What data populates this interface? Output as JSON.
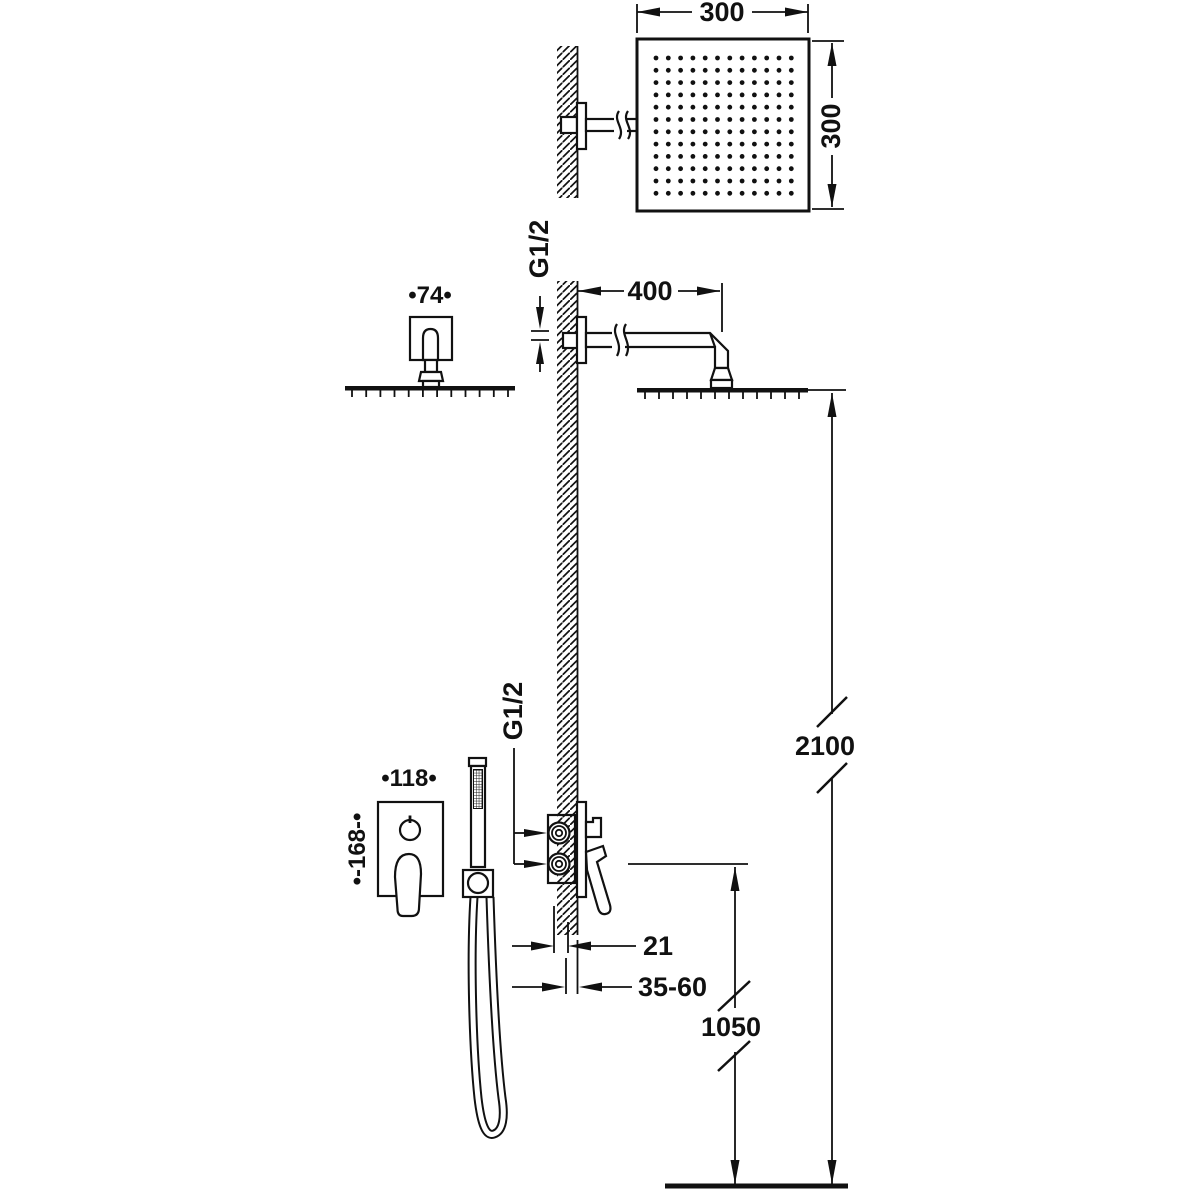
{
  "diagram": {
    "kind": "technical-installation-drawing",
    "colors": {
      "line": "#111111",
      "background": "#ffffff"
    }
  },
  "labels": {
    "head_width": "300",
    "head_height": "300",
    "arm_escutcheon_width": "•74•",
    "arm_thread": "G1/2",
    "arm_length": "400",
    "head_height_from_floor": "2100",
    "mixer_plate_width": "•118•",
    "mixer_plate_height": "•-168-•",
    "mixer_thread": "G1/2",
    "valve_protrusion": "21",
    "embedding_depth_range": "35-60",
    "mixer_height_from_floor": "1050"
  },
  "head_grid": {
    "rows": 12,
    "cols": 12
  }
}
